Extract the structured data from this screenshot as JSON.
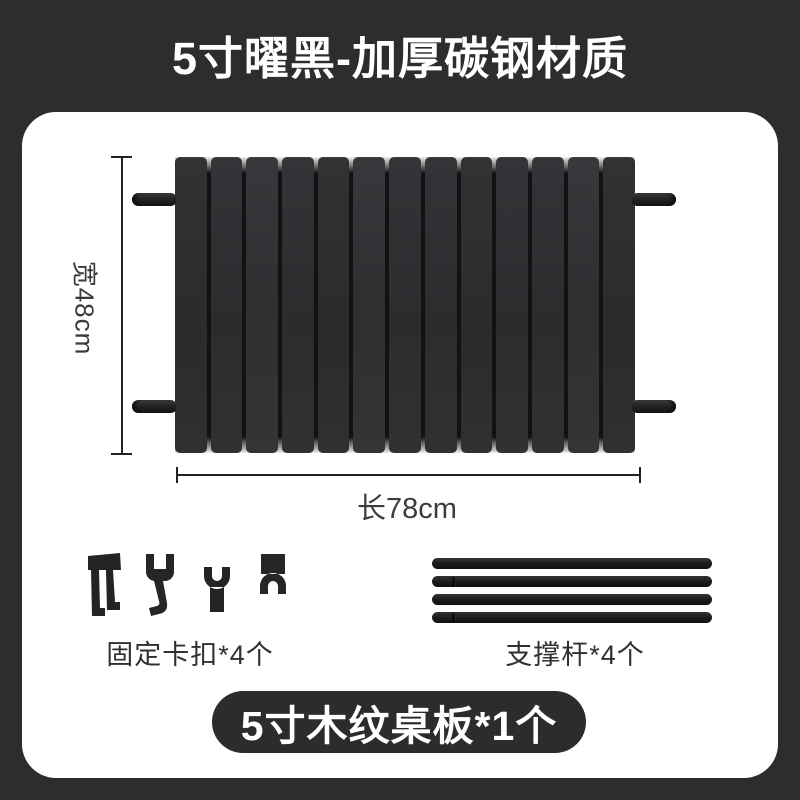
{
  "title": "5寸曜黑-加厚碳钢材质",
  "product": {
    "width_label": "宽48cm",
    "length_label": "长78cm",
    "slat_count": 13,
    "rod_count": 4
  },
  "parts": {
    "clips_label": "固定卡扣*4个",
    "rods_label": "支撑杆*4个"
  },
  "badge": {
    "label": "5寸木纹桌板*1个"
  },
  "colors": {
    "page_background": "#2e2d2e",
    "card_background": "#ffffff",
    "title_text": "#ffffff",
    "table_slat": "#2e3032",
    "dimension_line": "#222222",
    "dimension_text": "#3a3a3a",
    "part_silhouette": "#242424",
    "badge_background": "#2d2c2d",
    "badge_text": "#ffffff"
  }
}
